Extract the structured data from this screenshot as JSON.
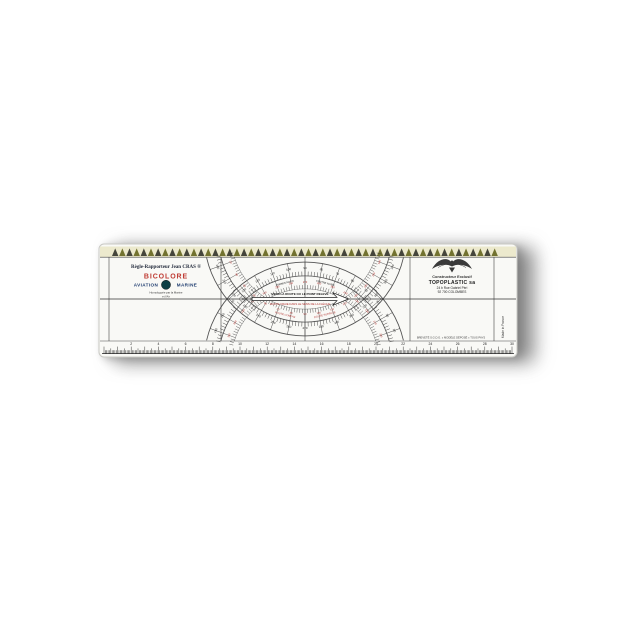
{
  "ruler": {
    "left_panel": {
      "title": "Règle-Rapporteur Jean CRAS ®",
      "subtitle": "BICOLORE",
      "use_left": "AVIATION",
      "use_right": "MARINE",
      "approval_line1": "Homologuée par la Marine",
      "approval_line2": "et l'Air"
    },
    "center": {
      "arrow_text_top": "VERS LA ROUTE OU LE POINT RELEVÉ",
      "arrow_text_bottom": "ROUTE VRAIE DANS LE SENS DE LA FLÈCHE",
      "inner_label_top_left": "CHEMIN NORD",
      "inner_label_top_right": "CENTRE NORD",
      "inner_label_bottom_left": "ROUTE COMPAS",
      "inner_label_bottom_right": "ROUTE SURFACE"
    },
    "right_panel": {
      "logo": "winged-eagle-emblem",
      "line1": "Constructeur Exclusif",
      "line2": "TOPOPLASTIC sa",
      "line3": "24 b Rue Gabriel Péri",
      "line4": "92 700 COLOMBES"
    },
    "footer": {
      "small_print": "BREVETÉ S.G.D.G. « MODÈLE DÉPOSÉ » TOUS PAYS",
      "made_in": "Made in France"
    },
    "colors": {
      "accent_red": "#b23430",
      "ink": "#1e1e1e",
      "navy": "#1d3b6e",
      "teal_dot": "#0e3f45",
      "body": "#f9f9f6"
    },
    "scales": {
      "protractor": {
        "number_step_deg": 10,
        "tick_step_deg": 2,
        "top_arc_range": [
          20,
          160
        ],
        "bottom_arc_range": [
          200,
          340
        ],
        "reciprocal_offset": 180
      },
      "bottom_ruler": {
        "unit": "cm",
        "length_cm": 30,
        "number_every_cm": 2
      },
      "top_scale": {
        "style": "sawtooth-triangles",
        "count": 54
      }
    }
  }
}
